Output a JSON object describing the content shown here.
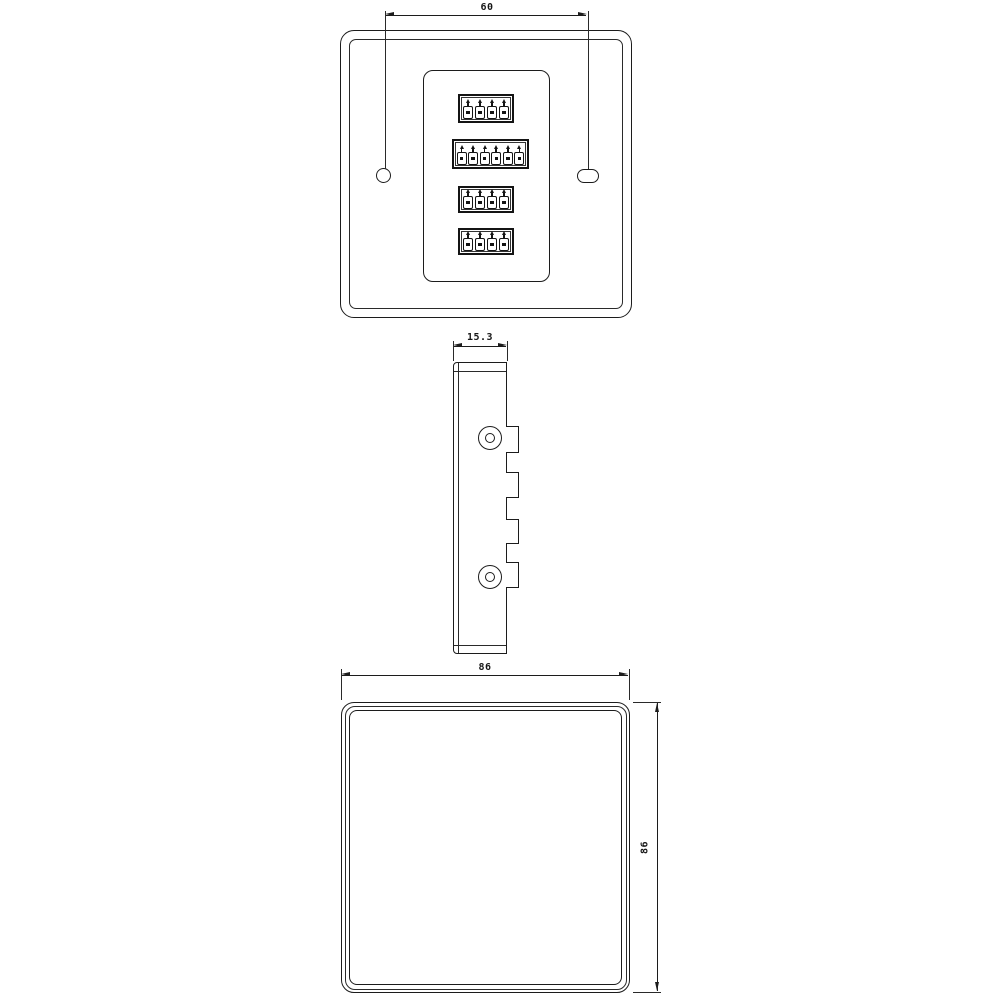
{
  "document": {
    "type": "technical-drawing",
    "subject": "wall panel module with terminal blocks",
    "background_color": "#ffffff",
    "line_color": "#1c1c1c"
  },
  "views": {
    "back": {
      "label": "back-view",
      "dimension_label": "60",
      "terminal_blocks": [
        {
          "pins": 4
        },
        {
          "pins": 6
        },
        {
          "pins": 4
        },
        {
          "pins": 4
        }
      ],
      "mounting_holes": {
        "left": "round-hole",
        "right": "slotted-hole"
      }
    },
    "side": {
      "label": "side-view",
      "dimension_label": "15.3",
      "screw_count": 2,
      "tab_count": 4
    },
    "front": {
      "label": "front-view",
      "width_label": "86",
      "height_label": "86"
    }
  }
}
